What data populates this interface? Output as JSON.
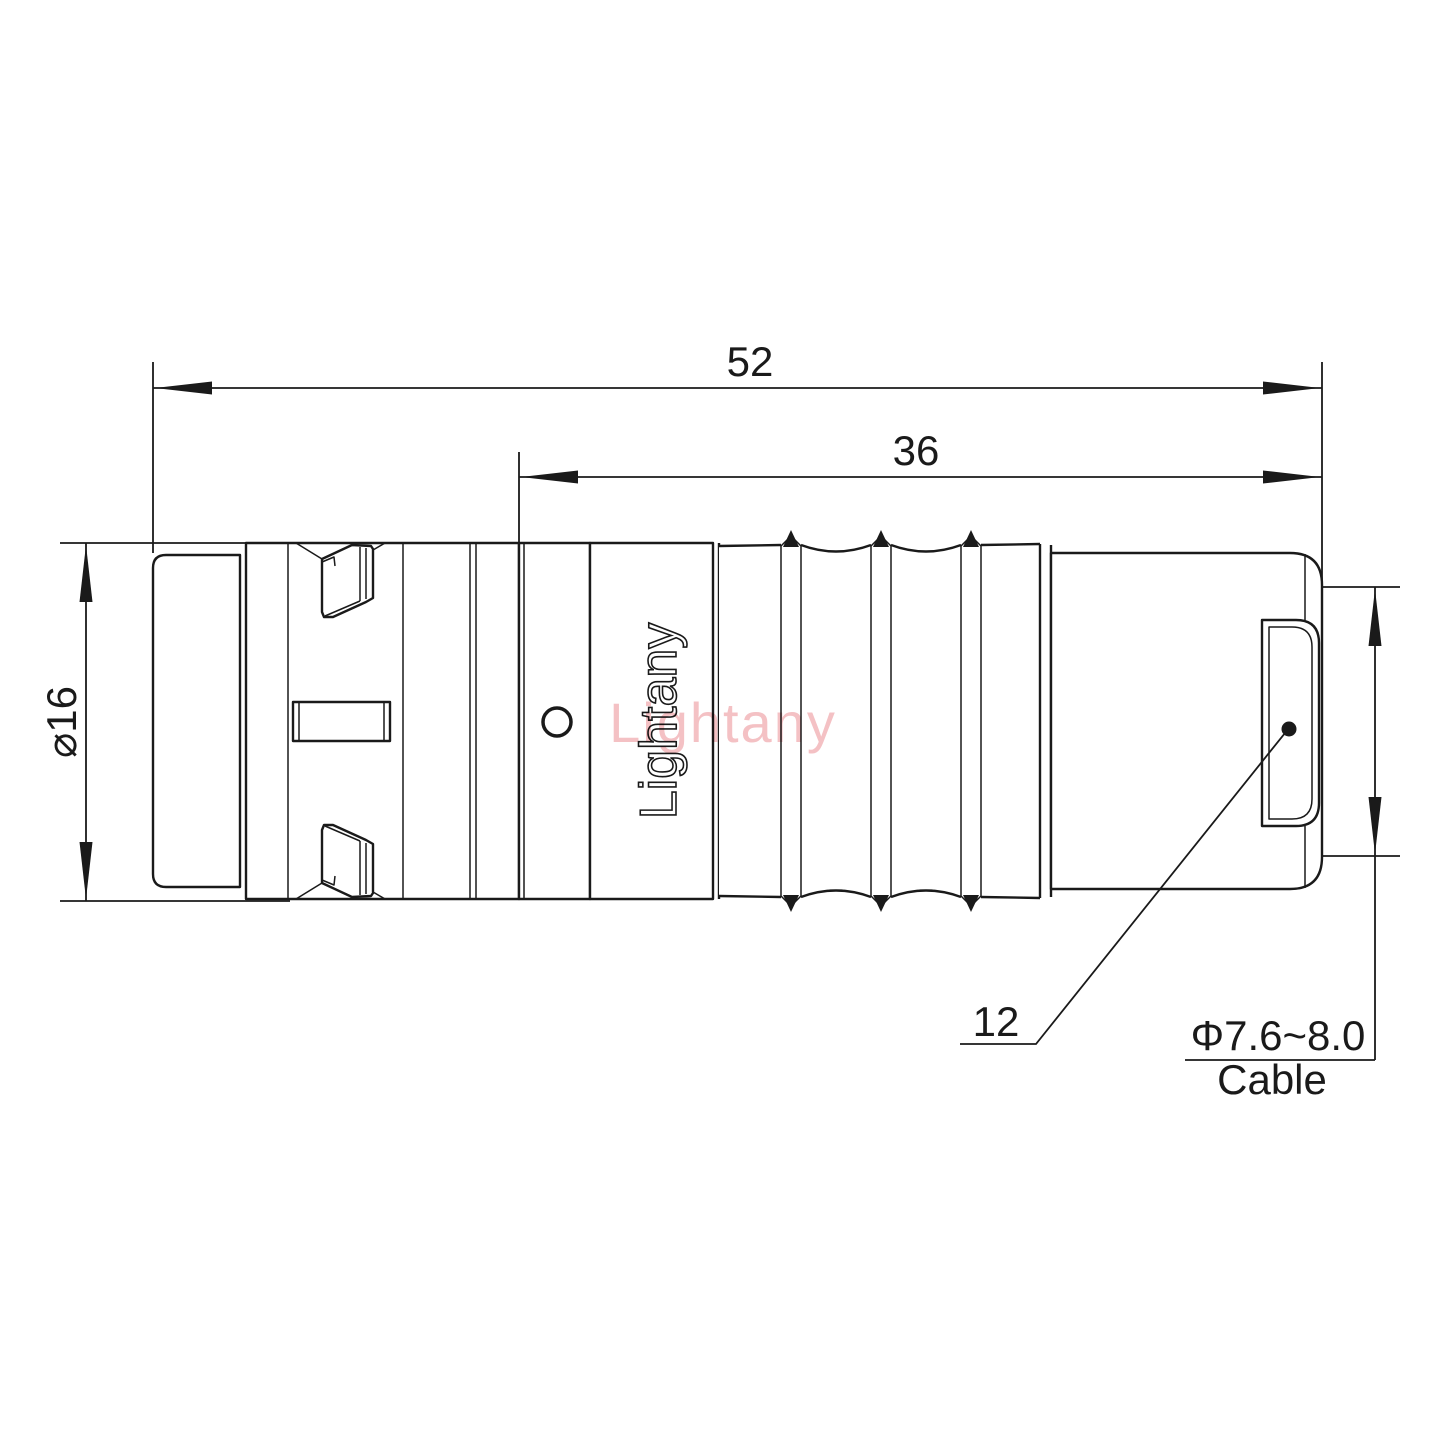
{
  "drawing": {
    "watermark_text": "Lightany",
    "body_brand_text": "Lightany"
  },
  "dimensions": {
    "overall_length": "52",
    "front_length": "36",
    "body_diameter": "⌀16",
    "rear_dimension": "12",
    "cable_range": "Φ7.6~8.0",
    "cable_word": "Cable"
  },
  "colors": {
    "line": "#1a1a1a",
    "watermark_pink": "#f2b6ba",
    "background": "#ffffff"
  }
}
